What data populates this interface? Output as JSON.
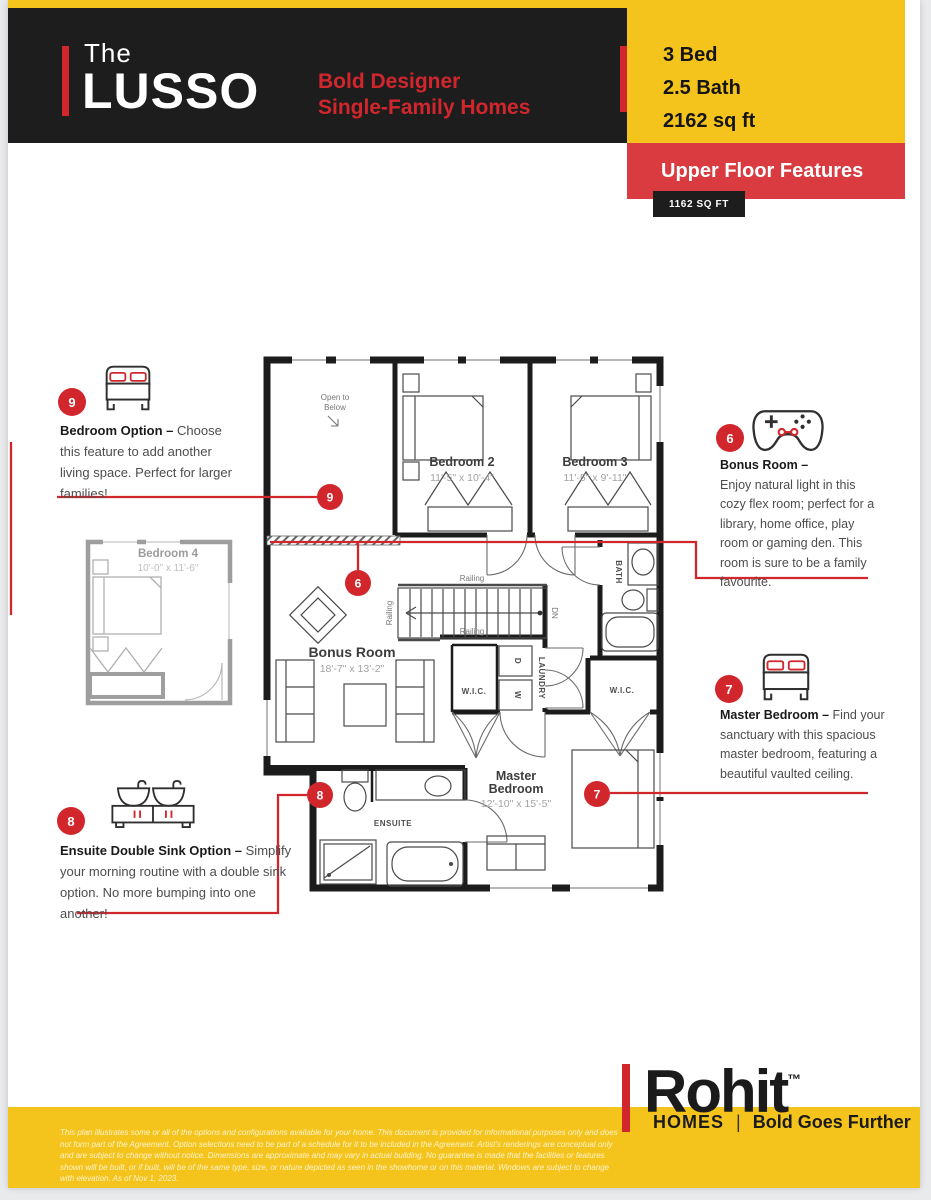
{
  "header": {
    "brand_prefix": "The",
    "brand_name": "LUSSO",
    "tagline_line1": "Bold Designer",
    "tagline_line2": "Single-Family Homes",
    "spec_bed": "3 Bed",
    "spec_bath": "2.5 Bath",
    "spec_sqft": "2162 sq ft",
    "section_title": "Upper Floor Features",
    "section_sqft": "1162 SQ FT"
  },
  "annotations": [
    {
      "number": "9",
      "icon": "bed-icon",
      "title": "Bedroom Option –",
      "body": "Choose this feature to add another living space. Perfect for larger families!"
    },
    {
      "number": "6",
      "icon": "controller-icon",
      "title": "Bonus Room –",
      "body": "Enjoy natural light in this cozy flex room; perfect for a library, home office, play room or gaming den. This room is sure to be a family favourite."
    },
    {
      "number": "7",
      "icon": "bed-icon",
      "title": "Master Bedroom –",
      "body": "Find your sanctuary with this spacious master bedroom, featuring a beautiful vaulted ceiling."
    },
    {
      "number": "8",
      "icon": "double-sink-icon",
      "title": "Ensuite Double Sink Option  –",
      "body": "Simplify your morning routine with a double sink option. No more bumping into one another!"
    }
  ],
  "floorplan": {
    "rooms": {
      "open_below": {
        "line1": "Open to",
        "line2": "Below"
      },
      "bedroom2": {
        "name": "Bedroom 2",
        "dims": "11'-5\" x 10'-4\""
      },
      "bedroom3": {
        "name": "Bedroom 3",
        "dims": "11'-5\" x 9'-11\""
      },
      "bonus": {
        "name": "Bonus Room",
        "dims": "18'-7\" x 13'-2\""
      },
      "master": {
        "name1": "Master",
        "name2": "Bedroom",
        "dims": "12'-10\" x 15'-5\""
      },
      "bedroom4": {
        "name": "Bedroom 4",
        "dims": "10'-0\" x 11'-6\""
      }
    },
    "labels": {
      "railing": "Railing",
      "dn": "DN",
      "wic": "W.I.C.",
      "laundry": "LAUNDRY",
      "bath": "BATH",
      "ensuite": "ENSUITE",
      "dryer": "D",
      "washer": "W"
    },
    "markers": {
      "m9": "9",
      "m6": "6",
      "m7": "7",
      "m8": "8"
    }
  },
  "footer": {
    "logo_name": "Rohit",
    "logo_tm": "™",
    "logo_sub": "HOMES",
    "logo_divider": "|",
    "logo_tagline": "Bold Goes Further",
    "disclaimer": "This plan illustrates some or all of the options and configurations available for your home. This document is provided for informational purposes only and does not form part of the Agreement. Option selections need to be part of a schedule for it to be included in the Agreement. Artist's renderings are conceptual only and are subject to change without notice. Dimensions are approximate and may vary in actual building. No guarantee is made that the facilities or features shown will be built, or if built, will be of the same type, size, or nature depicted as seen in the showhome or on this material. Windows are subject to change with elevation. As of Nov 1, 2023."
  },
  "colors": {
    "yellow": "#F5C41C",
    "red": "#D2262D",
    "red_box": "#D93B40",
    "black": "#1d1d1d"
  }
}
